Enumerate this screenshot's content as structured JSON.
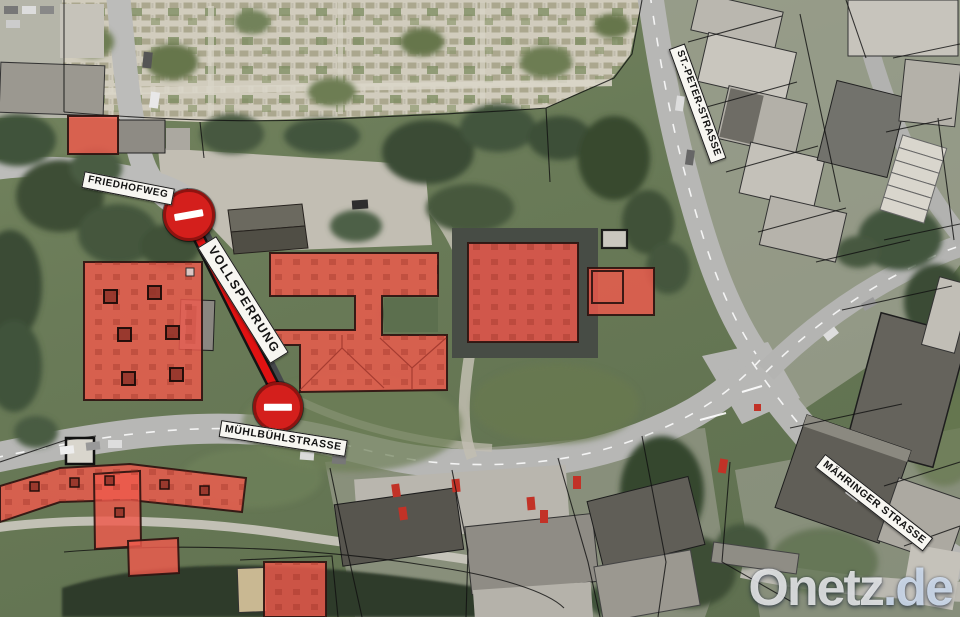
{
  "map": {
    "street_labels": {
      "friedhofweg": "FRIEDHOFWEG",
      "muehlbuehlstrasse": "MÜHLBÜHLSTRASSE",
      "st_peter_strasse": "ST.-PETER-STRASSE",
      "maehringer_strasse": "MÄHRINGER STRASSE"
    },
    "closure": {
      "label": "VOLLSPERRUNG",
      "sign_type": "no-entry",
      "sign_count": 2
    },
    "colors": {
      "closure_line": "#e01212",
      "highlight_building": "#ef5a4d",
      "no_entry_sign": "#d41f1c"
    },
    "watermark": {
      "brand": "Onetz",
      "tld": ".de"
    }
  }
}
